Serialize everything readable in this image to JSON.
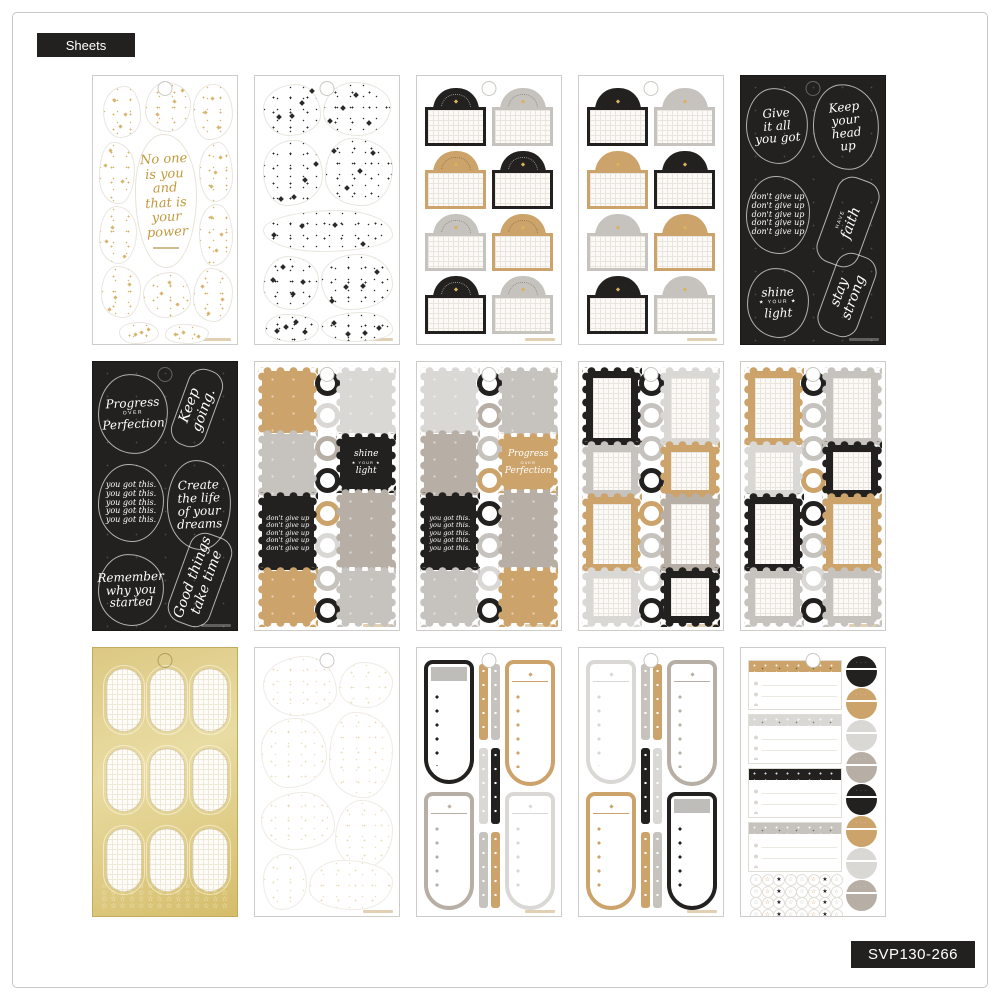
{
  "page": {
    "sheets_label": "Sheets",
    "sku": "SVP130-266"
  },
  "colors": {
    "black": "#232120",
    "tan": "#cca36a",
    "taupe": "#b7afa5",
    "gray": "#c6c3be",
    "lightgray": "#d9d8d5",
    "gold": "#d8c278",
    "sparkle_gold": "#d6b66e",
    "sparkle_black": "#2b2a28"
  },
  "sheets": [
    {
      "name": "gold-sparkle-quote-diecuts",
      "type": "blobs",
      "speckle": "gold",
      "quote": "No one is you and that is your power",
      "quote_lines": [
        "No one",
        "is you",
        "and",
        "that is",
        "your",
        "power"
      ]
    },
    {
      "name": "black-sparkle-diecuts",
      "type": "blobs",
      "speckle": "black"
    },
    {
      "name": "arch-labels-arc-text",
      "type": "arch",
      "arc": true,
      "cells": [
        [
          "black",
          "gray"
        ],
        [
          "tan",
          "black"
        ],
        [
          "gray",
          "tan"
        ],
        [
          "black",
          "gray"
        ]
      ]
    },
    {
      "name": "arch-labels-plain",
      "type": "arch",
      "arc": false,
      "cells": [
        [
          "black",
          "gray"
        ],
        [
          "tan",
          "black"
        ],
        [
          "gray",
          "tan"
        ],
        [
          "black",
          "gray"
        ]
      ]
    },
    {
      "name": "quotes-black-1",
      "type": "quotes",
      "quotes": [
        {
          "text": "Give it all you got",
          "lines": [
            "Give",
            "it all",
            "you got"
          ]
        },
        {
          "text": "Keep your head up",
          "lines": [
            "Keep",
            "your",
            "head",
            "up"
          ]
        },
        {
          "text": "don't give up",
          "lines": [
            "don't give up",
            "don't give up",
            "don't give up",
            "don't give up",
            "don't give up"
          ]
        },
        {
          "text": "have faith",
          "lines": [
            "HAVE",
            "faith"
          ],
          "rotated": true
        },
        {
          "text": "shine your light",
          "lines": [
            "shine",
            "★ YOUR ★",
            "light"
          ]
        },
        {
          "text": "stay strong",
          "lines": [
            "stay",
            "strong"
          ],
          "rotated": true
        }
      ]
    },
    {
      "name": "quotes-black-2",
      "type": "quotes",
      "quotes": [
        {
          "text": "Progress over Perfection",
          "lines": [
            "Progress",
            "OVER",
            "Perfection"
          ]
        },
        {
          "text": "Keep going.",
          "lines": [
            "Keep going."
          ],
          "rotated": true
        },
        {
          "text": "you got this.",
          "lines": [
            "you got this.",
            "you got this.",
            "you got this.",
            "you got this.",
            "you got this."
          ]
        },
        {
          "text": "Create the life of your dreams",
          "lines": [
            "Create",
            "the life",
            "of your",
            "dreams"
          ]
        },
        {
          "text": "Remember why you started",
          "lines": [
            "Remember",
            "why you",
            "started"
          ]
        },
        {
          "text": "Good things take time",
          "lines": [
            "Good things",
            "take time"
          ],
          "rotated": true
        }
      ]
    },
    {
      "name": "scallop-tiles-1",
      "type": "tiles",
      "left": [
        {
          "color": "tan",
          "size": "med"
        },
        {
          "color": "gray",
          "size": "med"
        },
        {
          "color": "black",
          "size": "tall",
          "quote": "dont"
        },
        {
          "color": "tan",
          "size": "sq"
        }
      ],
      "rings": [
        "black",
        "lightgray",
        "taupe",
        "black",
        "tan",
        "lightgray",
        "gray",
        "black"
      ],
      "right": [
        {
          "color": "lightgray",
          "size": "med"
        },
        {
          "color": "black",
          "size": "sq",
          "quote": "shine"
        },
        {
          "color": "taupe",
          "size": "tall"
        },
        {
          "color": "gray",
          "size": "sq"
        }
      ],
      "tile_quotes": {
        "dont": [
          "don't give up",
          "don't give up",
          "don't give up",
          "don't give up",
          "don't give up"
        ],
        "shine": [
          "shine",
          "★ YOUR ★",
          "light"
        ]
      }
    },
    {
      "name": "scallop-tiles-2",
      "type": "tiles",
      "left": [
        {
          "color": "lightgray",
          "size": "med"
        },
        {
          "color": "taupe",
          "size": "med"
        },
        {
          "color": "black",
          "size": "tall",
          "quote": "yougot"
        },
        {
          "color": "gray",
          "size": "sq"
        }
      ],
      "rings": [
        "black",
        "taupe",
        "gray",
        "tan",
        "black",
        "gray",
        "lightgray",
        "black"
      ],
      "right": [
        {
          "color": "gray",
          "size": "med"
        },
        {
          "color": "tan",
          "size": "sq",
          "quote": "progress"
        },
        {
          "color": "taupe",
          "size": "tall"
        },
        {
          "color": "tan",
          "size": "sq"
        }
      ],
      "tile_quotes": {
        "yougot": [
          "you got this.",
          "you got this.",
          "you got this.",
          "you got this.",
          "you got this."
        ],
        "progress": [
          "Progress",
          "OVER",
          "Perfection"
        ]
      }
    },
    {
      "name": "scallop-frames-1",
      "type": "frames",
      "left": [
        {
          "color": "black",
          "size": "tall"
        },
        {
          "color": "gray",
          "size": "sq"
        },
        {
          "color": "tan",
          "size": "tall"
        },
        {
          "color": "lightgray",
          "size": "sq"
        }
      ],
      "rings": [
        "black",
        "gray",
        "gray",
        "black",
        "tan",
        "gray",
        "lightgray",
        "black"
      ],
      "right": [
        {
          "color": "lightgray",
          "size": "tall"
        },
        {
          "color": "tan",
          "size": "sq"
        },
        {
          "color": "taupe",
          "size": "tall"
        },
        {
          "color": "black",
          "size": "sq"
        }
      ]
    },
    {
      "name": "scallop-frames-2",
      "type": "frames",
      "left": [
        {
          "color": "tan",
          "size": "tall"
        },
        {
          "color": "lightgray",
          "size": "sq"
        },
        {
          "color": "black",
          "size": "tall"
        },
        {
          "color": "gray",
          "size": "sq"
        }
      ],
      "rings": [
        "black",
        "gray",
        "gray",
        "tan",
        "black",
        "gray",
        "lightgray",
        "black"
      ],
      "right": [
        {
          "color": "gray",
          "size": "tall"
        },
        {
          "color": "black",
          "size": "sq"
        },
        {
          "color": "tan",
          "size": "tall"
        },
        {
          "color": "gray",
          "size": "sq"
        }
      ]
    },
    {
      "name": "gold-oval-labels",
      "type": "gold",
      "oval_rows": 3,
      "oval_cols": 3,
      "star_rows": 4
    },
    {
      "name": "faint-sparkle-diecuts",
      "type": "blobs",
      "speckle": "faint"
    },
    {
      "name": "bookmark-tabs-1",
      "type": "bookmarks",
      "quads": [
        {
          "color": "black",
          "header": "fill"
        },
        {
          "color": "tan"
        },
        {
          "color": "taupe"
        },
        {
          "color": "lightgray"
        }
      ],
      "strips": [
        [
          "tan",
          "gray"
        ],
        [
          "lightgray",
          "black"
        ],
        [
          "gray",
          "tan"
        ]
      ]
    },
    {
      "name": "bookmark-tabs-2",
      "type": "bookmarks",
      "quads": [
        {
          "color": "lightgray"
        },
        {
          "color": "taupe"
        },
        {
          "color": "tan"
        },
        {
          "color": "black",
          "header": "fill"
        }
      ],
      "strips": [
        [
          "gray",
          "tan"
        ],
        [
          "black",
          "lightgray"
        ],
        [
          "tan",
          "gray"
        ]
      ]
    },
    {
      "name": "checklists-and-dots",
      "type": "lists",
      "headers": [
        "tan",
        "lightgray",
        "black",
        "gray"
      ],
      "moons": [
        "black",
        "tan",
        "lightgray",
        "taupe",
        "black",
        "tan",
        "lightgray",
        "taupe"
      ],
      "star_colors": [
        "gray",
        "tan",
        "black",
        "gray",
        "gray",
        "tan",
        "black",
        "gray"
      ],
      "star_rows": 4
    }
  ]
}
